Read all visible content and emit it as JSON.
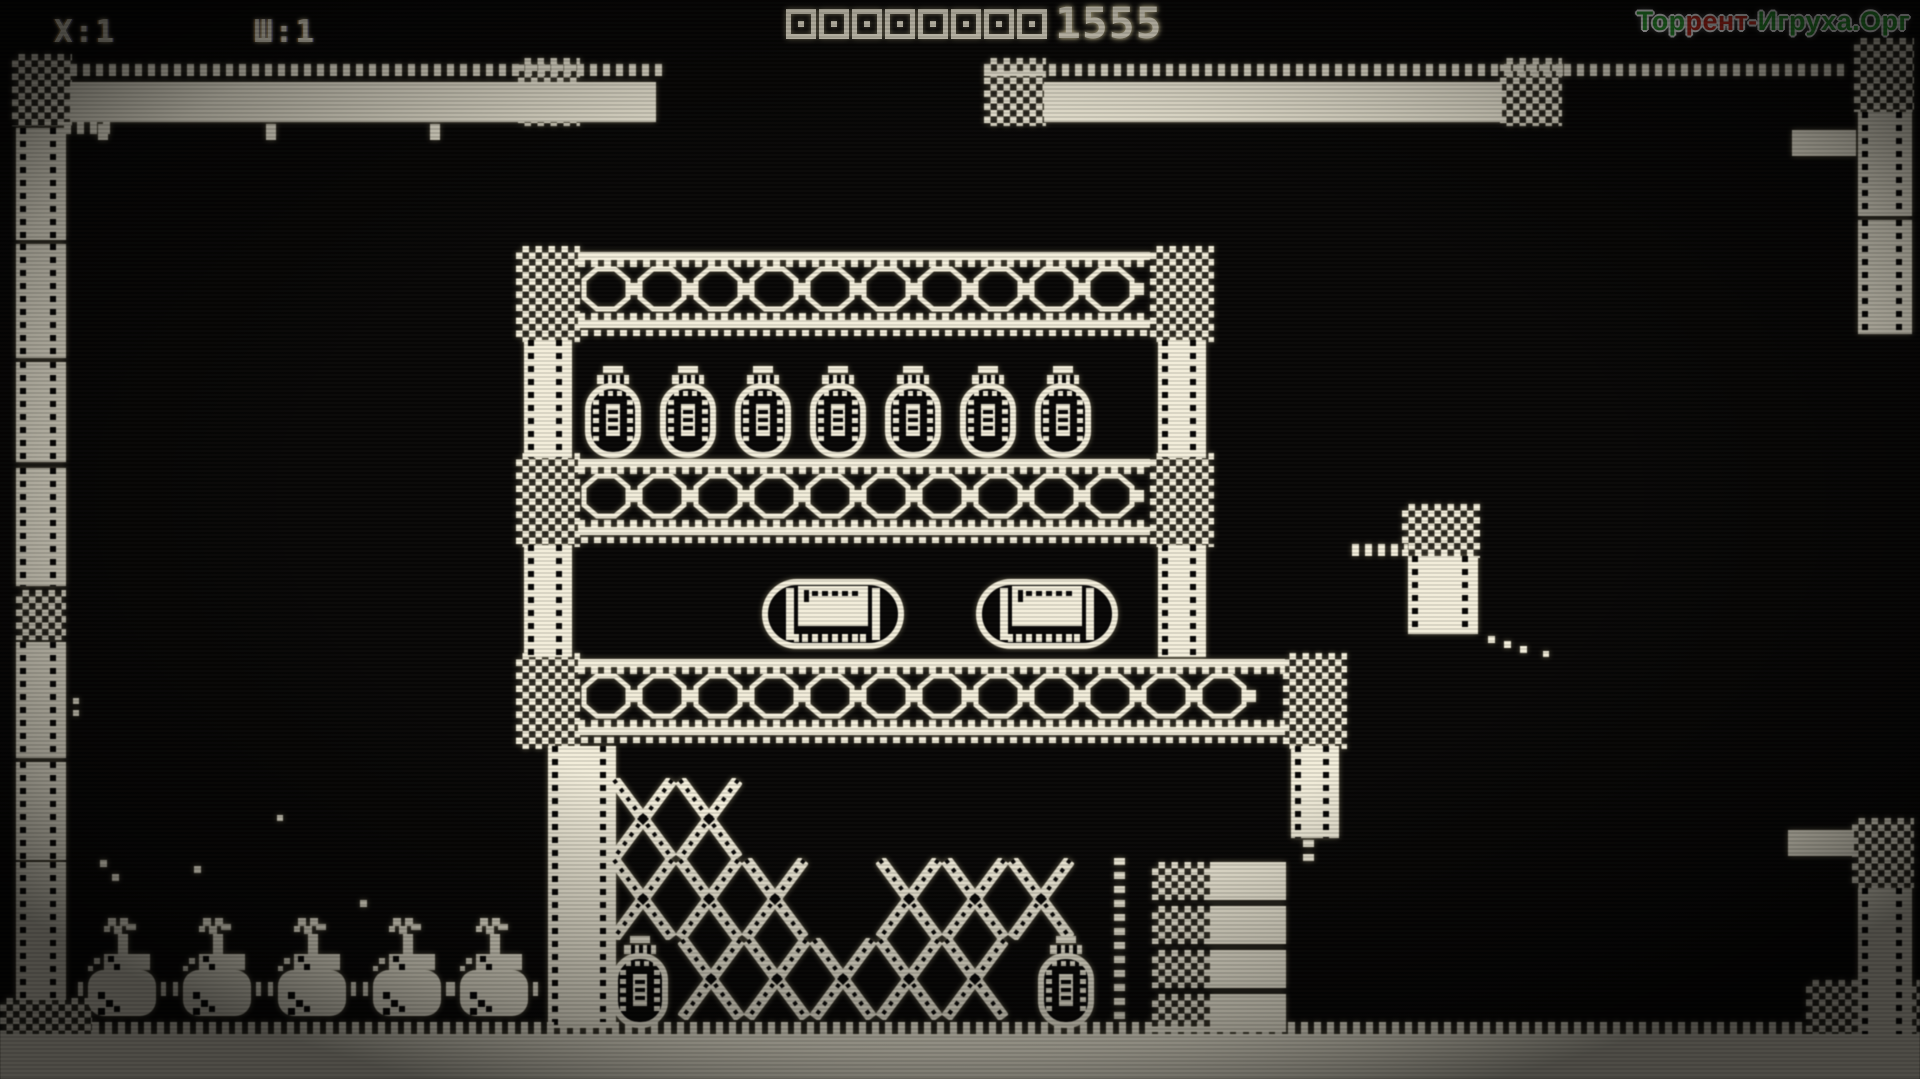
{
  "hud": {
    "lives_label": "X:1",
    "level_label": "Ш:1",
    "score_zeros": 8,
    "score_digits": "1555",
    "score_value": "000000001555"
  },
  "watermark": {
    "part1": "Тор",
    "part2": "рент-",
    "part3": "Игруха.Орг",
    "green": "#2fa433",
    "red": "#cd2c1e"
  },
  "colors": {
    "phosphor": "#f2edda",
    "background": "#080706"
  },
  "scene": {
    "bands": [
      {
        "x": 578,
        "y": 252,
        "w": 572
      },
      {
        "x": 578,
        "y": 459,
        "w": 572
      },
      {
        "x": 578,
        "y": 659,
        "w": 707
      }
    ],
    "checkers": [
      {
        "x": 12,
        "y": 54,
        "w": 60,
        "h": 72
      },
      {
        "x": 518,
        "y": 58,
        "w": 62,
        "h": 68
      },
      {
        "x": 984,
        "y": 58,
        "w": 62,
        "h": 68
      },
      {
        "x": 1500,
        "y": 58,
        "w": 62,
        "h": 68
      },
      {
        "x": 1854,
        "y": 38,
        "w": 60,
        "h": 74
      },
      {
        "x": 516,
        "y": 246,
        "w": 64,
        "h": 96
      },
      {
        "x": 1150,
        "y": 246,
        "w": 64,
        "h": 96
      },
      {
        "x": 516,
        "y": 453,
        "w": 64,
        "h": 94
      },
      {
        "x": 1150,
        "y": 453,
        "w": 64,
        "h": 94
      },
      {
        "x": 516,
        "y": 653,
        "w": 64,
        "h": 96
      },
      {
        "x": 1283,
        "y": 653,
        "w": 64,
        "h": 96
      },
      {
        "x": 16,
        "y": 590,
        "w": 50,
        "h": 50
      },
      {
        "x": 1402,
        "y": 504,
        "w": 78,
        "h": 54
      },
      {
        "x": 1852,
        "y": 818,
        "w": 62,
        "h": 70
      },
      {
        "x": 0,
        "y": 998,
        "w": 92,
        "h": 81
      },
      {
        "x": 1806,
        "y": 980,
        "w": 114,
        "h": 99
      },
      {
        "x": 345,
        "y": 1048,
        "w": 208,
        "h": 31
      },
      {
        "x": 1030,
        "y": 1042,
        "w": 76,
        "h": 37
      },
      {
        "x": 1580,
        "y": 1048,
        "w": 110,
        "h": 31
      }
    ],
    "pillars": [
      {
        "x": 16,
        "y": 128,
        "w": 50,
        "h": 112
      },
      {
        "x": 16,
        "y": 244,
        "w": 50,
        "h": 114
      },
      {
        "x": 16,
        "y": 362,
        "w": 50,
        "h": 100
      },
      {
        "x": 16,
        "y": 468,
        "w": 50,
        "h": 118
      },
      {
        "x": 16,
        "y": 642,
        "w": 50,
        "h": 116
      },
      {
        "x": 16,
        "y": 762,
        "w": 50,
        "h": 98
      },
      {
        "x": 16,
        "y": 862,
        "w": 50,
        "h": 138
      },
      {
        "x": 524,
        "y": 340,
        "w": 48,
        "h": 118
      },
      {
        "x": 1158,
        "y": 340,
        "w": 48,
        "h": 118
      },
      {
        "x": 524,
        "y": 545,
        "w": 48,
        "h": 112
      },
      {
        "x": 1158,
        "y": 545,
        "w": 48,
        "h": 112
      },
      {
        "x": 548,
        "y": 746,
        "w": 68,
        "h": 282
      },
      {
        "x": 1291,
        "y": 746,
        "w": 48,
        "h": 92
      },
      {
        "x": 1408,
        "y": 556,
        "w": 70,
        "h": 78
      },
      {
        "x": 1858,
        "y": 112,
        "w": 54,
        "h": 104
      },
      {
        "x": 1858,
        "y": 220,
        "w": 54,
        "h": 114
      },
      {
        "x": 1858,
        "y": 888,
        "w": 54,
        "h": 148
      }
    ],
    "bars": [
      {
        "x": 70,
        "y": 82,
        "w": 586,
        "h": 40
      },
      {
        "x": 1044,
        "y": 82,
        "w": 458,
        "h": 40
      },
      {
        "x": 1792,
        "y": 130,
        "w": 64,
        "h": 26
      },
      {
        "x": 1788,
        "y": 830,
        "w": 66,
        "h": 26
      },
      {
        "x": 0,
        "y": 1034,
        "w": 1920,
        "h": 45
      }
    ],
    "dashes": [
      {
        "x": 70,
        "y": 64,
        "w": 592,
        "h": 12
      },
      {
        "x": 984,
        "y": 64,
        "w": 580,
        "h": 12
      },
      {
        "x": 1564,
        "y": 64,
        "w": 280,
        "h": 12
      },
      {
        "x": 64,
        "y": 122,
        "w": 52,
        "h": 12
      },
      {
        "x": 1352,
        "y": 544,
        "w": 56,
        "h": 12
      },
      {
        "x": 92,
        "y": 1022,
        "w": 1714,
        "h": 13
      }
    ],
    "vdots": [
      {
        "x": 1114,
        "y": 858,
        "w": 11,
        "h": 168
      },
      {
        "x": 1303,
        "y": 840,
        "w": 11,
        "h": 26
      }
    ],
    "pods": [
      {
        "x": 585,
        "y": 366
      },
      {
        "x": 660,
        "y": 366
      },
      {
        "x": 735,
        "y": 366
      },
      {
        "x": 810,
        "y": 366
      },
      {
        "x": 885,
        "y": 366
      },
      {
        "x": 960,
        "y": 366
      },
      {
        "x": 1035,
        "y": 366
      },
      {
        "x": 612,
        "y": 936
      },
      {
        "x": 1038,
        "y": 936
      }
    ],
    "capsules": [
      {
        "x": 762,
        "y": 566
      },
      {
        "x": 976,
        "y": 566
      }
    ],
    "xcells": [
      {
        "x": 610,
        "y": 778
      },
      {
        "x": 676,
        "y": 778
      },
      {
        "x": 610,
        "y": 858
      },
      {
        "x": 676,
        "y": 858
      },
      {
        "x": 742,
        "y": 858
      },
      {
        "x": 876,
        "y": 858
      },
      {
        "x": 942,
        "y": 858
      },
      {
        "x": 1008,
        "y": 858
      },
      {
        "x": 678,
        "y": 938
      },
      {
        "x": 744,
        "y": 938
      },
      {
        "x": 810,
        "y": 938
      },
      {
        "x": 876,
        "y": 938
      },
      {
        "x": 942,
        "y": 938
      }
    ],
    "plates": [
      {
        "x": 1152,
        "y": 862
      },
      {
        "x": 1152,
        "y": 906
      },
      {
        "x": 1152,
        "y": 950
      },
      {
        "x": 1152,
        "y": 994
      }
    ],
    "bottles": [
      {
        "x": 78,
        "y": 918
      },
      {
        "x": 173,
        "y": 918
      },
      {
        "x": 268,
        "y": 918
      },
      {
        "x": 363,
        "y": 918
      },
      {
        "x": 450,
        "y": 918
      }
    ],
    "hooks": [
      {
        "x": 98,
        "y": 124
      },
      {
        "x": 266,
        "y": 124
      },
      {
        "x": 430,
        "y": 124
      }
    ],
    "dots": [
      {
        "x": 100,
        "y": 860,
        "s": 7
      },
      {
        "x": 112,
        "y": 874,
        "s": 7
      },
      {
        "x": 194,
        "y": 866,
        "s": 7
      },
      {
        "x": 360,
        "y": 900,
        "s": 7
      },
      {
        "x": 277,
        "y": 815,
        "s": 6
      },
      {
        "x": 73,
        "y": 698,
        "s": 6
      },
      {
        "x": 73,
        "y": 710,
        "s": 6
      },
      {
        "x": 1488,
        "y": 636,
        "s": 7
      },
      {
        "x": 1504,
        "y": 641,
        "s": 7
      },
      {
        "x": 1520,
        "y": 646,
        "s": 7
      },
      {
        "x": 1543,
        "y": 651,
        "s": 6
      }
    ]
  }
}
